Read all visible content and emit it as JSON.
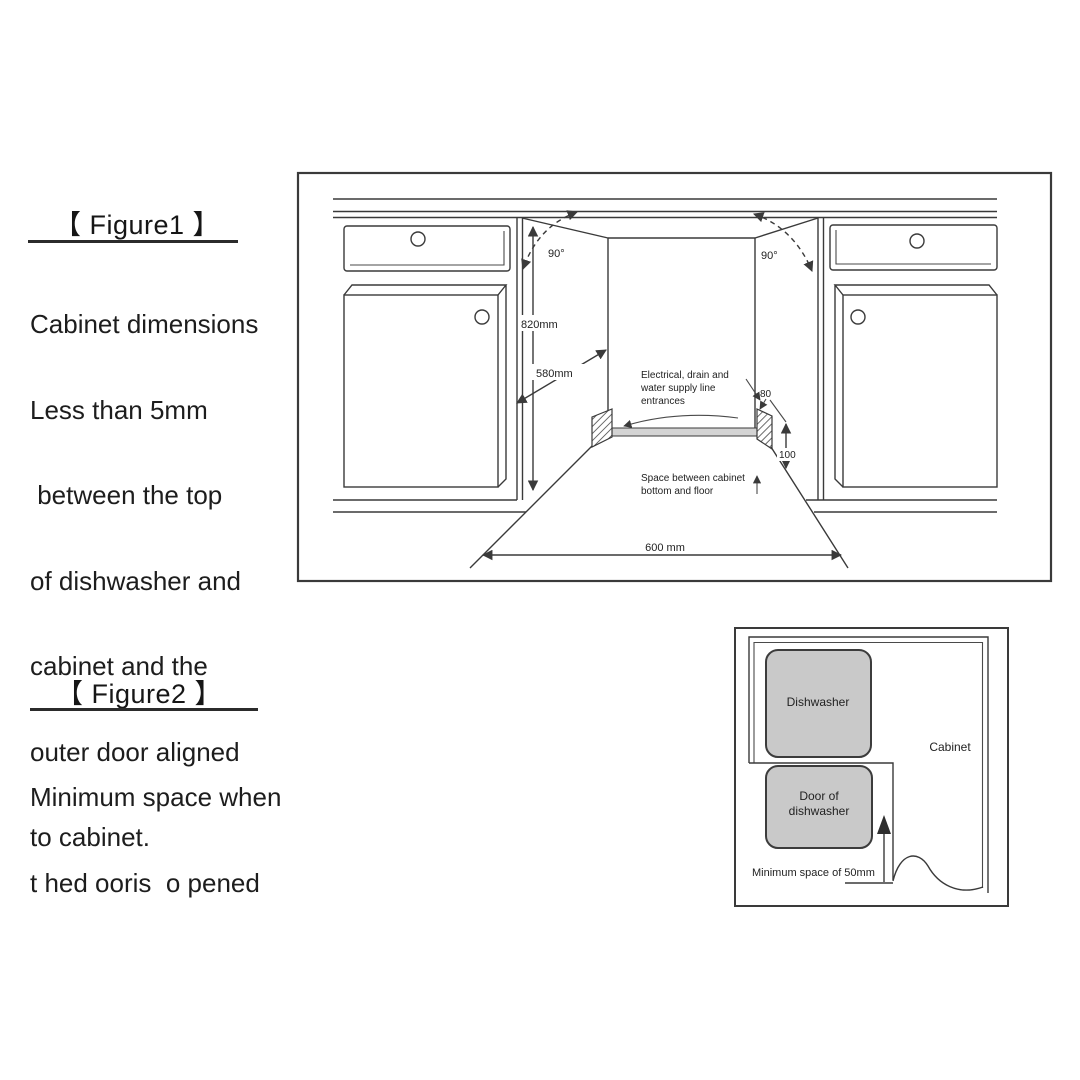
{
  "figure1": {
    "heading": "【 Figure1 】",
    "caption_lines": [
      "Cabinet dimensions",
      "Less than 5mm",
      " between the top",
      "of dishwasher and",
      "cabinet and the",
      "outer door aligned",
      "to cabinet."
    ],
    "diagram": {
      "angle_left": "90°",
      "angle_right": "90°",
      "niche_height": "820mm",
      "niche_depth": "580mm",
      "niche_width": "600 mm",
      "entrance_width": "80",
      "floor_space_height": "100",
      "entrance_label_lines": [
        "Electrical, drain and",
        "water supply line",
        "entrances"
      ],
      "floor_space_label_lines": [
        "Space between cabinet",
        "bottom and floor"
      ]
    }
  },
  "figure2": {
    "heading": "【 Figure2 】",
    "caption_lines": [
      "Minimum space when",
      "t hed ooris  o pened"
    ],
    "diagram": {
      "dishwasher_label": "Dishwasher",
      "door_label_lines": [
        "Door of",
        "dishwasher"
      ],
      "cabinet_label": "Cabinet",
      "min_space_label": "Minimum space of 50mm"
    }
  },
  "colors": {
    "line": "#3a3a3a",
    "text": "#1d1d1d",
    "gray_box_fill": "#c9c9c9",
    "floor_band_fill": "#d4d4d4"
  }
}
